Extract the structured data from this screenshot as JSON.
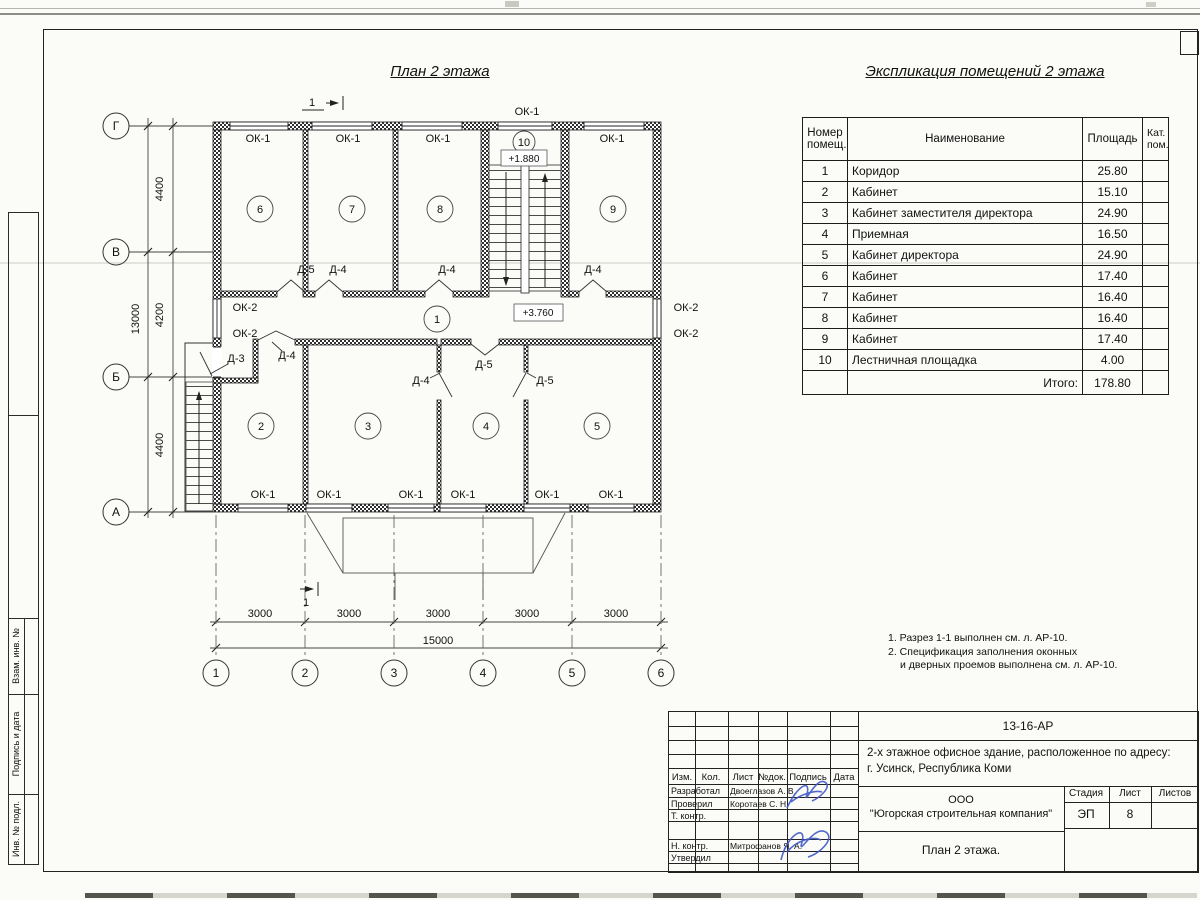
{
  "titles": {
    "plan": "План 2 этажа",
    "table": "Экспликация помещений 2 этажа"
  },
  "table": {
    "col_number": "Номер помещ.",
    "col_name": "Наименование",
    "col_area": "Площадь",
    "col_cat": "Кат. пом.",
    "rows": [
      {
        "n": "1",
        "name": "Коридор",
        "area": "25.80"
      },
      {
        "n": "2",
        "name": "Кабинет",
        "area": "15.10"
      },
      {
        "n": "3",
        "name": "Кабинет заместителя директора",
        "area": "24.90"
      },
      {
        "n": "4",
        "name": "Приемная",
        "area": "16.50"
      },
      {
        "n": "5",
        "name": "Кабинет директора",
        "area": "24.90"
      },
      {
        "n": "6",
        "name": "Кабинет",
        "area": "17.40"
      },
      {
        "n": "7",
        "name": "Кабинет",
        "area": "16.40"
      },
      {
        "n": "8",
        "name": "Кабинет",
        "area": "16.40"
      },
      {
        "n": "9",
        "name": "Кабинет",
        "area": "17.40"
      },
      {
        "n": "10",
        "name": "Лестничная площадка",
        "area": "4.00"
      }
    ],
    "total_label": "Итого:",
    "total_value": "178.80"
  },
  "plan": {
    "lbl": {
      "ok1": "ОК-1",
      "ok2": "ОК-2",
      "d3": "Д-3",
      "d4": "Д-4",
      "d5": "Д-5"
    },
    "room_numbers": [
      "1",
      "2",
      "3",
      "4",
      "5",
      "6",
      "7",
      "8",
      "9",
      "10"
    ],
    "levels": {
      "stair": "+1.880",
      "corridor": "+3.760"
    },
    "axes": {
      "rows": [
        "Г",
        "В",
        "Б",
        "А"
      ],
      "cols": [
        "1",
        "2",
        "3",
        "4",
        "5",
        "6"
      ]
    },
    "dims": {
      "left": [
        "4400",
        "4200",
        "4400"
      ],
      "left_total": "13000",
      "bottom": [
        "3000",
        "3000",
        "3000",
        "3000",
        "3000"
      ],
      "bottom_total": "15000"
    },
    "section_mark": "1"
  },
  "notes": {
    "line1": "1. Разрез 1-1 выполнен см. л. АР-10.",
    "line2": "2. Спецификация заполнения оконных",
    "line3": "и дверных проемов выполнена см. л. АР-10."
  },
  "titleblock": {
    "doc_code": "13-16-АР",
    "object_line1": "2-х этажное офисное здание, расположенное по адресу:",
    "object_line2": "г. Усинск, Республика Коми",
    "company_line1": "ООО",
    "company_line2": "\"Югорская строительная компания\"",
    "sheet_title": "План 2 этажа.",
    "stage_label": "Стадия",
    "sheet_label": "Лист",
    "sheets_label": "Листов",
    "stage_value": "ЭП",
    "sheet_value": "8",
    "hdr": {
      "izm": "Изм.",
      "kol": "Кол.",
      "list": "Лист",
      "ndok": "№док.",
      "podpis": "Подпись",
      "data": "Дата"
    },
    "roles": {
      "developed": "Разработал",
      "checked": "Проверил",
      "tcontrol": "Т. контр.",
      "ncontrol": "Н. контр.",
      "approved": "Утвердил"
    },
    "names": {
      "developed": "Двоеглазов А. В.",
      "checked": "Коротаев С. Н.",
      "ncontrol": "Митрофанов Я. А."
    }
  },
  "stamp_left": {
    "box1": "Взам. инв. №",
    "box2": "Подпись и дата",
    "box3": "Инв. № подл."
  }
}
